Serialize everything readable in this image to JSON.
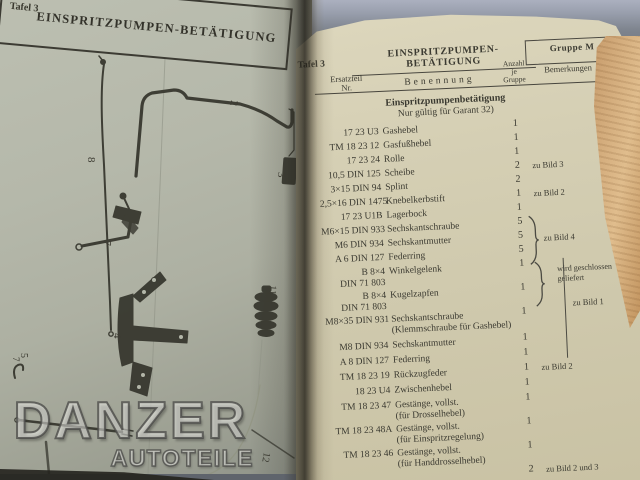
{
  "colors": {
    "left_paper": "#b5b8aa",
    "right_paper": "#d5cfb4",
    "page_edges_tan": "#d0a878",
    "background": "#6a6f78",
    "ink": "#3b3a31",
    "watermark": "#f8f8f4"
  },
  "watermark": {
    "line1": "DANZER",
    "line2": "AUTOTEILE"
  },
  "left_page": {
    "corner_label": "Tafel 3",
    "title": "EINSPRITZPUMPEN-BETÄTIGUNG",
    "callouts": {
      "c8": "8",
      "c2": "2",
      "c3": "3",
      "c7": "7",
      "c7b": "7",
      "c5": "5",
      "c4": "4",
      "c11": "11",
      "c12": "12",
      "c6": "6"
    }
  },
  "right_page": {
    "corner_label": "Tafel 3",
    "title": "EINSPRITZPUMPEN-BETÄTIGUNG",
    "group_label": "Gruppe M",
    "columns": {
      "nr": "Ersatzteil\nNr.",
      "name": "Benennung",
      "qty": "Anzahl\nje\nGruppe",
      "remarks": "Bemerkungen"
    },
    "section": {
      "title": "Einspritzpumpenbetätigung",
      "subtitle": "Nur gültig für Garant 32)"
    },
    "rows": [
      {
        "nr": "17 23 U3",
        "name": "Gashebel",
        "qty": "1"
      },
      {
        "nr": "TM 18 23 12",
        "name": "Gasfußhebel",
        "qty": "1"
      },
      {
        "nr": "17 23 24",
        "name": "Rolle",
        "qty": "1"
      },
      {
        "nr": "10,5 DIN 125",
        "name": "Scheibe",
        "qty": "2",
        "remark": "zu Bild 3"
      },
      {
        "nr": "3×15 DIN 94",
        "name": "Splint",
        "qty": "2"
      },
      {
        "nr": "2,5×16 DIN 1475",
        "name": "Knebelkerbstift",
        "qty": "1",
        "remark": "zu Bild 2"
      },
      {
        "nr": "17 23 U1B",
        "name": "Lagerbock",
        "qty": "1"
      },
      {
        "nr": "M6×15 DIN 933",
        "name": "Sechskantschraube",
        "qty": "5"
      },
      {
        "nr": "M6 DIN 934",
        "name": "Sechskantmutter",
        "qty": "5"
      },
      {
        "nr": "A 6 DIN 127",
        "name": "Federring",
        "qty": "5"
      },
      {
        "nr": "B 8×4\nDIN 71 803",
        "name": "Winkelgelenk",
        "qty": "1"
      },
      {
        "nr": "B 8×4\nDIN 71 803",
        "name": "Kugelzapfen",
        "qty": "1"
      },
      {
        "nr": "M8×35 DIN 931",
        "name": "Sechskantschraube\n(Klemmschraube für Gashebel)",
        "qty": "1"
      },
      {
        "nr": "M8 DIN 934",
        "name": "Sechskantmutter",
        "qty": "1"
      },
      {
        "nr": "A 8 DIN 127",
        "name": "Federring",
        "qty": "1"
      },
      {
        "nr": "TM 18 23 19",
        "name": "Rückzugfeder",
        "qty": "1",
        "remark": "zu Bild 2"
      },
      {
        "nr": "18 23 U4",
        "name": "Zwischenhebel",
        "qty": "1"
      },
      {
        "nr": "TM 18 23 47",
        "name": "Gestänge, vollst.\n(für Drosselhebel)",
        "qty": "1"
      },
      {
        "nr": "TM 18 23 48A",
        "name": "Gestänge, vollst.\n(für Einspritzregelung)",
        "qty": "1"
      },
      {
        "nr": "TM 18 23 46",
        "name": "Gestänge, vollst.\n(für Handdrosselhebel)",
        "qty": "1"
      },
      {
        "nr": "",
        "name": "",
        "qty": "2",
        "remark": "zu Bild 2 und 3"
      }
    ],
    "braces": {
      "bild4": "zu Bild 4",
      "geschlossen": "wird geschlossen\ngeliefert",
      "bild1": "zu Bild 1"
    }
  }
}
